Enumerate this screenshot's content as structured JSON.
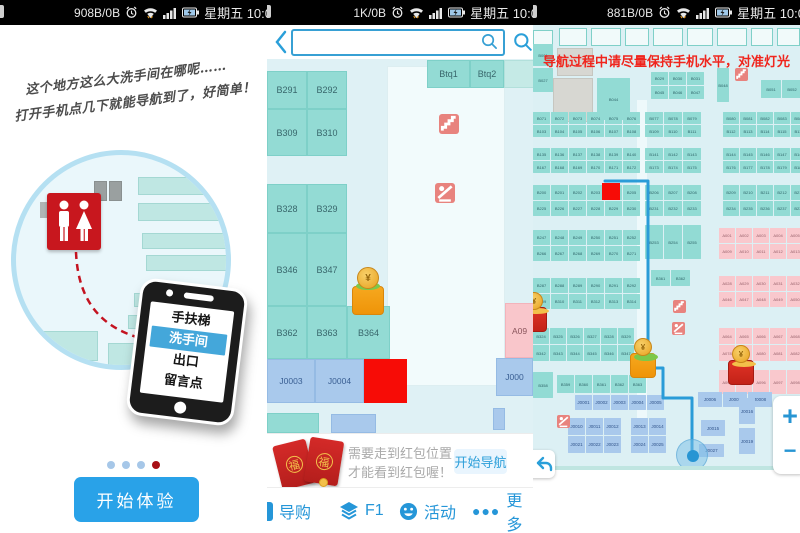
{
  "status": {
    "left": {
      "data": "908B/0B",
      "daytime": "星期五 10:0"
    },
    "middle": {
      "data": "1K/0B",
      "daytime": "星期五 10:0"
    },
    "right": {
      "data": "881B/0B",
      "daytime": "星期五 10:0"
    }
  },
  "colors": {
    "accent_blue": "#2a9fd9",
    "teal_fill": "#92dbd4",
    "pink_fill": "#f9c8cd",
    "blue_fill": "#a9c9ec",
    "map_bg": "#dff1f5",
    "red_block": "#f70c06",
    "icon_red": "#e8837e",
    "path_blue": "#2a9cd8",
    "warning_red": "#f0251d",
    "restroom_red": "#c8171e",
    "button_blue": "#29a2e8",
    "envelope_red": "#c1272d",
    "gold": "#f5a623"
  },
  "intro": {
    "caption_line1": "这个地方这么大洗手间在哪呢……",
    "caption_line2": "打开手机点几下就能导航到了，好简单！",
    "phone_menu": [
      "手扶梯",
      "洗手间",
      "出口",
      "留言点"
    ],
    "active_item": "洗手间",
    "dots": [
      "inactive",
      "inactive",
      "inactive",
      "active"
    ],
    "start_button": "开始体验"
  },
  "mapview": {
    "search": {
      "value": "",
      "placeholder": ""
    },
    "blocks": [
      {
        "label": "B291",
        "x": 0,
        "y": 12,
        "w": 40,
        "h": 38,
        "type": "teal"
      },
      {
        "label": "B292",
        "x": 40,
        "y": 12,
        "w": 40,
        "h": 38,
        "type": "teal"
      },
      {
        "label": "B309",
        "x": 0,
        "y": 50,
        "w": 40,
        "h": 47,
        "type": "teal"
      },
      {
        "label": "B310",
        "x": 40,
        "y": 50,
        "w": 40,
        "h": 47,
        "type": "teal"
      },
      {
        "label": "B328",
        "x": 0,
        "y": 125,
        "w": 40,
        "h": 49,
        "type": "teal"
      },
      {
        "label": "B329",
        "x": 40,
        "y": 125,
        "w": 40,
        "h": 49,
        "type": "teal"
      },
      {
        "label": "B346",
        "x": 0,
        "y": 174,
        "w": 40,
        "h": 73,
        "type": "teal"
      },
      {
        "label": "B347",
        "x": 40,
        "y": 174,
        "w": 40,
        "h": 73,
        "type": "teal"
      },
      {
        "label": "B362",
        "x": 0,
        "y": 247,
        "w": 40,
        "h": 53,
        "type": "teal"
      },
      {
        "label": "B363",
        "x": 40,
        "y": 247,
        "w": 40,
        "h": 53,
        "type": "teal"
      },
      {
        "label": "B364",
        "x": 80,
        "y": 247,
        "w": 43,
        "h": 53,
        "type": "teal"
      },
      {
        "label": "Btq1",
        "x": 160,
        "y": 1,
        "w": 43,
        "h": 28,
        "type": "teal"
      },
      {
        "label": "Btq2",
        "x": 203,
        "y": 1,
        "w": 34,
        "h": 28,
        "type": "teal"
      },
      {
        "label": "",
        "x": 237,
        "y": 1,
        "w": 30,
        "h": 28,
        "type": "teallight"
      },
      {
        "label": "J0003",
        "x": 0,
        "y": 300,
        "w": 48,
        "h": 44,
        "type": "blue"
      },
      {
        "label": "J0004",
        "x": 48,
        "y": 300,
        "w": 49,
        "h": 44,
        "type": "blue"
      },
      {
        "label": "",
        "x": 97,
        "y": 300,
        "w": 43,
        "h": 44,
        "type": "red"
      },
      {
        "label": "A09",
        "x": 238,
        "y": 244,
        "w": 29,
        "h": 55,
        "type": "pink"
      },
      {
        "label": "J000",
        "x": 229,
        "y": 299,
        "w": 37,
        "h": 38,
        "type": "blue"
      },
      {
        "label": "",
        "x": 0,
        "y": 354,
        "w": 52,
        "h": 20,
        "type": "teal"
      },
      {
        "label": "",
        "x": 64,
        "y": 355,
        "w": 45,
        "h": 19,
        "type": "blue"
      },
      {
        "label": "",
        "x": 226,
        "y": 349,
        "w": 12,
        "h": 22,
        "type": "blue"
      }
    ],
    "icons": [
      {
        "name": "stairs-icon",
        "x": 172,
        "y": 55
      },
      {
        "name": "escalator-icon",
        "x": 168,
        "y": 124
      }
    ],
    "mascots": [
      {
        "type": "gold",
        "x": 85,
        "y": 208
      }
    ],
    "banner": {
      "line1": "需要走到红包位置，",
      "line2": "才能看到红包喔！",
      "button": "开始导航",
      "envelope_char": "福"
    },
    "nav": [
      {
        "label": "导购",
        "icon": "guide-icon"
      },
      {
        "label": "F1",
        "icon": "layers-icon"
      },
      {
        "label": "活动",
        "icon": "smiley-icon"
      },
      {
        "label": "更多",
        "icon": "more-icon"
      }
    ]
  },
  "navview": {
    "warning": "导航过程中请尽量保持手机水平，对准灯光",
    "band_cells": [
      [
        0,
        5,
        20,
        26
      ],
      [
        26,
        3,
        28,
        18
      ],
      [
        58,
        3,
        30,
        18
      ],
      [
        92,
        3,
        24,
        18
      ],
      [
        120,
        3,
        30,
        18
      ],
      [
        154,
        3,
        26,
        18
      ],
      [
        184,
        3,
        30,
        18
      ],
      [
        218,
        3,
        22,
        18
      ],
      [
        244,
        3,
        23,
        18
      ]
    ],
    "gray_blocks": [
      [
        24,
        23,
        36,
        28
      ],
      [
        20,
        53,
        40,
        44
      ]
    ],
    "clusters": [
      {
        "x": 0,
        "y": 19,
        "cw": 20,
        "ch": 22,
        "type": "teal",
        "rows": [
          [
            "B001"
          ]
        ]
      },
      {
        "x": 0,
        "y": 43,
        "cw": 20,
        "ch": 24,
        "type": "teal",
        "rows": [
          [
            "B027"
          ]
        ]
      },
      {
        "x": 64,
        "y": 53,
        "cw": 33,
        "ch": 42,
        "type": "teal",
        "rows": [
          [
            "B044"
          ]
        ]
      },
      {
        "x": 118,
        "y": 47,
        "cw": 17,
        "ch": 13,
        "type": "teal",
        "rows": [
          [
            "B029",
            "B030",
            "B031"
          ],
          [
            "B045",
            "B046",
            "B047"
          ]
        ]
      },
      {
        "x": 184,
        "y": 43,
        "cw": 12,
        "ch": 34,
        "type": "teal",
        "rows": [
          [
            "B048"
          ]
        ]
      },
      {
        "x": 228,
        "y": 55,
        "cw": 20,
        "ch": 18,
        "type": "teal",
        "rows": [
          [
            "B051",
            "B052"
          ]
        ]
      },
      {
        "x": 0,
        "y": 87,
        "cw": 17,
        "ch": 12,
        "type": "teal",
        "rows": [
          [
            "B071",
            "B072",
            "B073",
            "B074",
            "B075",
            "B076"
          ],
          [
            "B103",
            "B104",
            "B105",
            "B106",
            "B107",
            "B108"
          ]
        ]
      },
      {
        "x": 112,
        "y": 87,
        "cw": 18,
        "ch": 12,
        "type": "teal",
        "rows": [
          [
            "B077",
            "B078",
            "B079"
          ],
          [
            "B109",
            "B110",
            "B111"
          ]
        ]
      },
      {
        "x": 190,
        "y": 87,
        "cw": 16,
        "ch": 12,
        "type": "teal",
        "rows": [
          [
            "B080",
            "B081",
            "B082",
            "B083",
            "B084"
          ],
          [
            "B112",
            "B113",
            "B114",
            "B115",
            "B116"
          ]
        ]
      },
      {
        "x": 0,
        "y": 123,
        "cw": 17,
        "ch": 12,
        "type": "teal",
        "rows": [
          [
            "B135",
            "B136",
            "B137",
            "B138",
            "B139",
            "B140"
          ],
          [
            "B167",
            "B168",
            "B169",
            "B170",
            "B171",
            "B172"
          ]
        ]
      },
      {
        "x": 112,
        "y": 123,
        "cw": 18,
        "ch": 12,
        "type": "teal",
        "rows": [
          [
            "B141",
            "B142",
            "B143"
          ],
          [
            "B173",
            "B174",
            "B175"
          ]
        ]
      },
      {
        "x": 190,
        "y": 123,
        "cw": 16,
        "ch": 12,
        "type": "teal",
        "rows": [
          [
            "B144",
            "B145",
            "B146",
            "B147",
            "B148"
          ],
          [
            "B176",
            "B177",
            "B178",
            "B179",
            "B180"
          ]
        ]
      },
      {
        "x": 0,
        "y": 160,
        "cw": 17,
        "ch": 15,
        "type": "teal",
        "rows": [
          [
            "B200",
            "B201",
            "B202",
            "B203",
            "",
            "B205"
          ],
          [
            "B225",
            "B226",
            "B227",
            "B228",
            "B229",
            "B230"
          ]
        ]
      },
      {
        "x": 112,
        "y": 160,
        "cw": 18,
        "ch": 15,
        "type": "teal",
        "rows": [
          [
            "B206",
            "B207",
            "B208"
          ],
          [
            "B231",
            "B232",
            "B233"
          ]
        ]
      },
      {
        "x": 190,
        "y": 160,
        "cw": 16,
        "ch": 15,
        "type": "teal",
        "rows": [
          [
            "B209",
            "B210",
            "B211",
            "B212",
            "B213"
          ],
          [
            "B234",
            "B235",
            "B236",
            "B237",
            "B238"
          ]
        ]
      },
      {
        "x": 0,
        "y": 205,
        "cw": 17,
        "ch": 15,
        "type": "teal",
        "rows": [
          [
            "B247",
            "B248",
            "B249",
            "B250",
            "B251",
            "B252"
          ],
          [
            "B266",
            "B267",
            "B268",
            "B269",
            "B270",
            "B271"
          ]
        ]
      },
      {
        "x": 112,
        "y": 200,
        "cw": 18,
        "ch": 34,
        "type": "teal",
        "rows": [
          [
            "B253",
            "B254",
            "B255"
          ]
        ]
      },
      {
        "x": 186,
        "y": 203,
        "cw": 16,
        "ch": 15,
        "type": "pink",
        "rows": [
          [
            "A001",
            "A002",
            "A003",
            "A004",
            "A005"
          ],
          [
            "A009",
            "A010",
            "A011",
            "A012",
            "A013"
          ]
        ]
      },
      {
        "x": 0,
        "y": 253,
        "cw": 17,
        "ch": 15,
        "type": "teal",
        "rows": [
          [
            "B287",
            "B288",
            "B289",
            "B290",
            "B291",
            "B292"
          ],
          [
            "B309",
            "B310",
            "B311",
            "B312",
            "B313",
            "B314"
          ]
        ]
      },
      {
        "x": 118,
        "y": 245,
        "cw": 19,
        "ch": 16,
        "type": "teal",
        "rows": [
          [
            "B361",
            "B362"
          ]
        ]
      },
      {
        "x": 186,
        "y": 251,
        "cw": 16,
        "ch": 15,
        "type": "pink",
        "rows": [
          [
            "A028",
            "A029",
            "A030",
            "A031",
            "A032"
          ],
          [
            "A046",
            "A047",
            "A048",
            "A049",
            "A050"
          ]
        ]
      },
      {
        "x": 0,
        "y": 303,
        "cw": 16,
        "ch": 16,
        "type": "teal",
        "rows": [
          [
            "B324",
            "B325",
            "B326",
            "B327",
            "B328",
            "B329"
          ],
          [
            "B342",
            "B343",
            "B344",
            "B345",
            "B346",
            "B347"
          ]
        ]
      },
      {
        "x": 186,
        "y": 303,
        "cw": 16,
        "ch": 16,
        "type": "pink",
        "rows": [
          [
            "A064",
            "A065",
            "A066",
            "A067",
            "A068"
          ],
          [
            "A078",
            "A079",
            "A080",
            "A081",
            "A082"
          ]
        ]
      },
      {
        "x": 0,
        "y": 347,
        "cw": 20,
        "ch": 26,
        "type": "teal",
        "rows": [
          [
            "B358"
          ]
        ]
      },
      {
        "x": 24,
        "y": 350,
        "cw": 17,
        "ch": 18,
        "type": "teal",
        "rows": [
          [
            "B359",
            "B360",
            "B361",
            "B362",
            "B363"
          ]
        ]
      },
      {
        "x": 186,
        "y": 345,
        "cw": 16,
        "ch": 24,
        "type": "pink",
        "rows": [
          [
            "A094",
            "A095",
            "A096",
            "A097",
            "A098"
          ]
        ]
      },
      {
        "x": 42,
        "y": 370,
        "cw": 17,
        "ch": 15,
        "type": "blue",
        "rows": [
          [
            "J0001",
            "J0002",
            "J0003",
            "J0004",
            "J0005"
          ]
        ]
      },
      {
        "x": 35,
        "y": 393,
        "cw": 17,
        "ch": 17,
        "type": "blue",
        "rows": [
          [
            "J0010",
            "J0011",
            "J0012"
          ],
          [
            "J0021",
            "J0022",
            "J0023"
          ]
        ]
      },
      {
        "x": 98,
        "y": 393,
        "cw": 17,
        "ch": 17,
        "type": "blue",
        "rows": [
          [
            "J0013",
            "J0014"
          ],
          [
            "J0024",
            "J0025"
          ]
        ]
      },
      {
        "x": 165,
        "y": 367,
        "cw": 24,
        "ch": 15,
        "type": "blue",
        "rows": [
          [
            "J0006",
            "J0007",
            "J0008"
          ]
        ]
      },
      {
        "x": 168,
        "y": 395,
        "cw": 24,
        "ch": 16,
        "type": "blue",
        "rows": [
          [
            "J0015"
          ]
        ]
      },
      {
        "x": 206,
        "y": 373,
        "cw": 16,
        "ch": 26,
        "type": "blue",
        "rows": [
          [
            "J0016"
          ]
        ]
      },
      {
        "x": 206,
        "y": 403,
        "cw": 16,
        "ch": 26,
        "type": "blue",
        "rows": [
          [
            "J0019"
          ]
        ]
      },
      {
        "x": 166,
        "y": 419,
        "cw": 25,
        "ch": 13,
        "type": "blue",
        "rows": [
          [
            "J0027"
          ]
        ]
      }
    ],
    "red_cell": {
      "x": 69,
      "y": 158,
      "w": 18,
      "h": 17
    },
    "path": [
      [
        72,
        156
      ],
      [
        115,
        156
      ],
      [
        115,
        343
      ],
      [
        130,
        343
      ],
      [
        130,
        373
      ],
      [
        159,
        373
      ],
      [
        159,
        427
      ]
    ],
    "location": {
      "x": 143,
      "y": 414
    },
    "icons": [
      {
        "name": "stairs-icon",
        "x": 202,
        "y": 43
      },
      {
        "name": "stairs-icon",
        "x": 140,
        "y": 275
      },
      {
        "name": "escalator-icon",
        "x": 139,
        "y": 297
      },
      {
        "name": "escalator-icon",
        "x": 24,
        "y": 390
      }
    ],
    "mascots": [
      {
        "type": "red",
        "x": -12,
        "y": 267
      },
      {
        "type": "gold",
        "x": 97,
        "y": 313
      },
      {
        "type": "red",
        "x": 195,
        "y": 320
      }
    ],
    "zoom_plus": "+",
    "zoom_minus": "−"
  }
}
